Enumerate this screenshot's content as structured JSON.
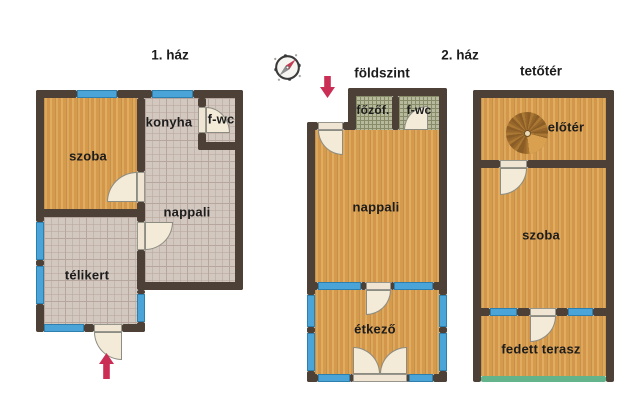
{
  "plans": {
    "house1": {
      "title": "1. ház",
      "rooms": {
        "szoba": "szoba",
        "konyha": "konyha",
        "fwc": "f-wc",
        "nappali": "nappali",
        "telikert": "télikert"
      }
    },
    "house2": {
      "title": "2. ház",
      "ground_floor": {
        "title": "földszint",
        "rooms": {
          "fozofulke": "főzőf.",
          "fwc": "f-wc",
          "nappali": "nappali",
          "etkezo": "étkező"
        }
      },
      "attic": {
        "title": "tetőtér",
        "rooms": {
          "eloter": "előtér",
          "szoba": "szoba",
          "fedett_terasz": "fedett terasz"
        }
      }
    }
  },
  "icons": {
    "compass": "compass-icon",
    "entrance_arrow_house1": "arrow-up-icon",
    "entrance_arrow_house2": "arrow-down-icon",
    "spiral_staircase": "spiral-staircase-icon"
  },
  "colors": {
    "background": "#ffffff",
    "wall": "#4c4037",
    "wood_floor": "#d9a050",
    "tile_floor": "#d3c8bf",
    "tile_grid": "#b7a69e",
    "wet_room_tile": "#b7ba9d",
    "window": "#4ba4d8",
    "door": "#f3ead8",
    "entrance_arrow": "#cb2e55",
    "terrace_open_edge": "#63b48b",
    "staircase_brown": "#96662a",
    "compass_needle_red": "#c43a50",
    "compass_needle_gray": "#8e8e8e",
    "text": "#1c1c1c"
  }
}
